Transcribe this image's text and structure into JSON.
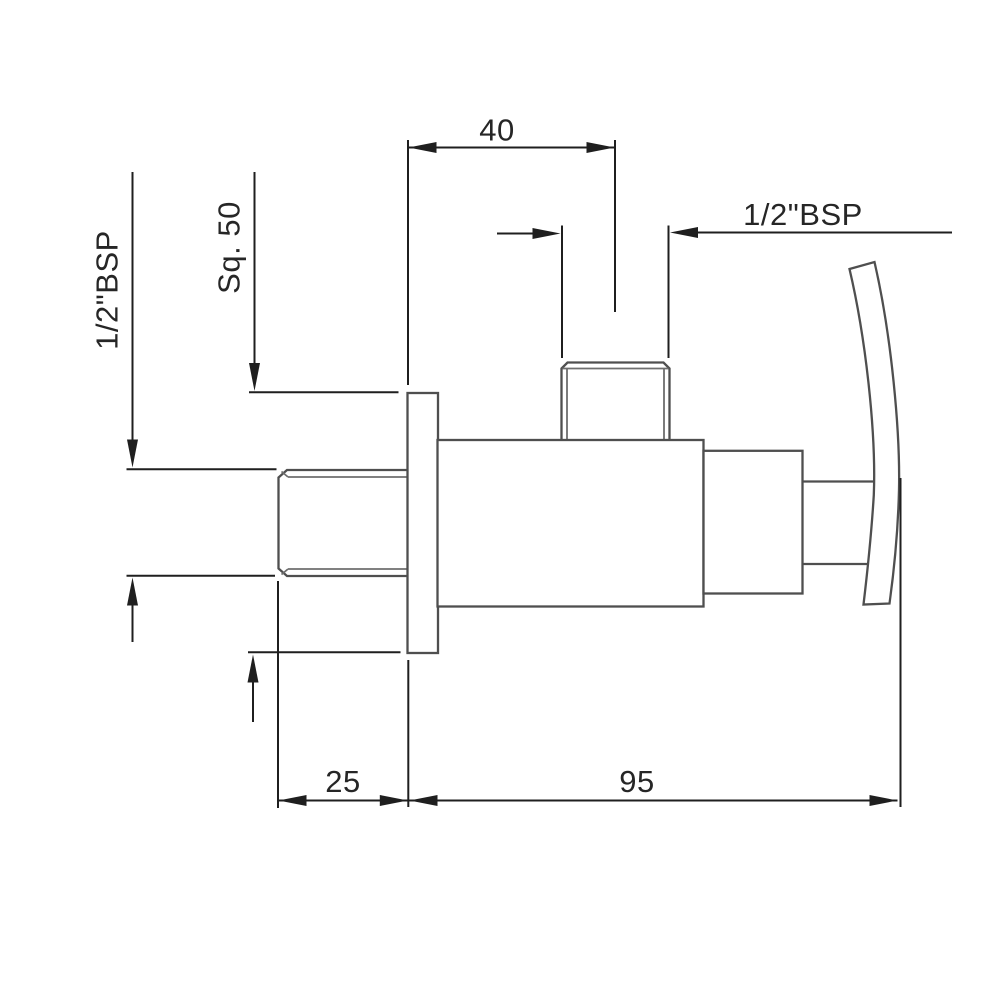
{
  "drawing": {
    "title": "Angle valve technical drawing - side elevation",
    "type": "dimensioned engineering line drawing",
    "background_color": "#ffffff",
    "outline_color": "#4f4f4f",
    "thread_line_color": "#6e6e6e",
    "dimension_line_color": "#1f1f1f",
    "text_color": "#262626",
    "parts": [
      "inlet nipple (threaded)",
      "wall flange plate",
      "valve body",
      "top outlet port (threaded)",
      "bonnet",
      "stem",
      "curved lever handle"
    ]
  },
  "dimensions": {
    "top_width": "40",
    "outlet_thread": "1/2\"BSP",
    "inlet_thread": "1/2\"BSP",
    "flange_square": "Sq. 50",
    "flange_depth": "25",
    "body_length": "95"
  }
}
